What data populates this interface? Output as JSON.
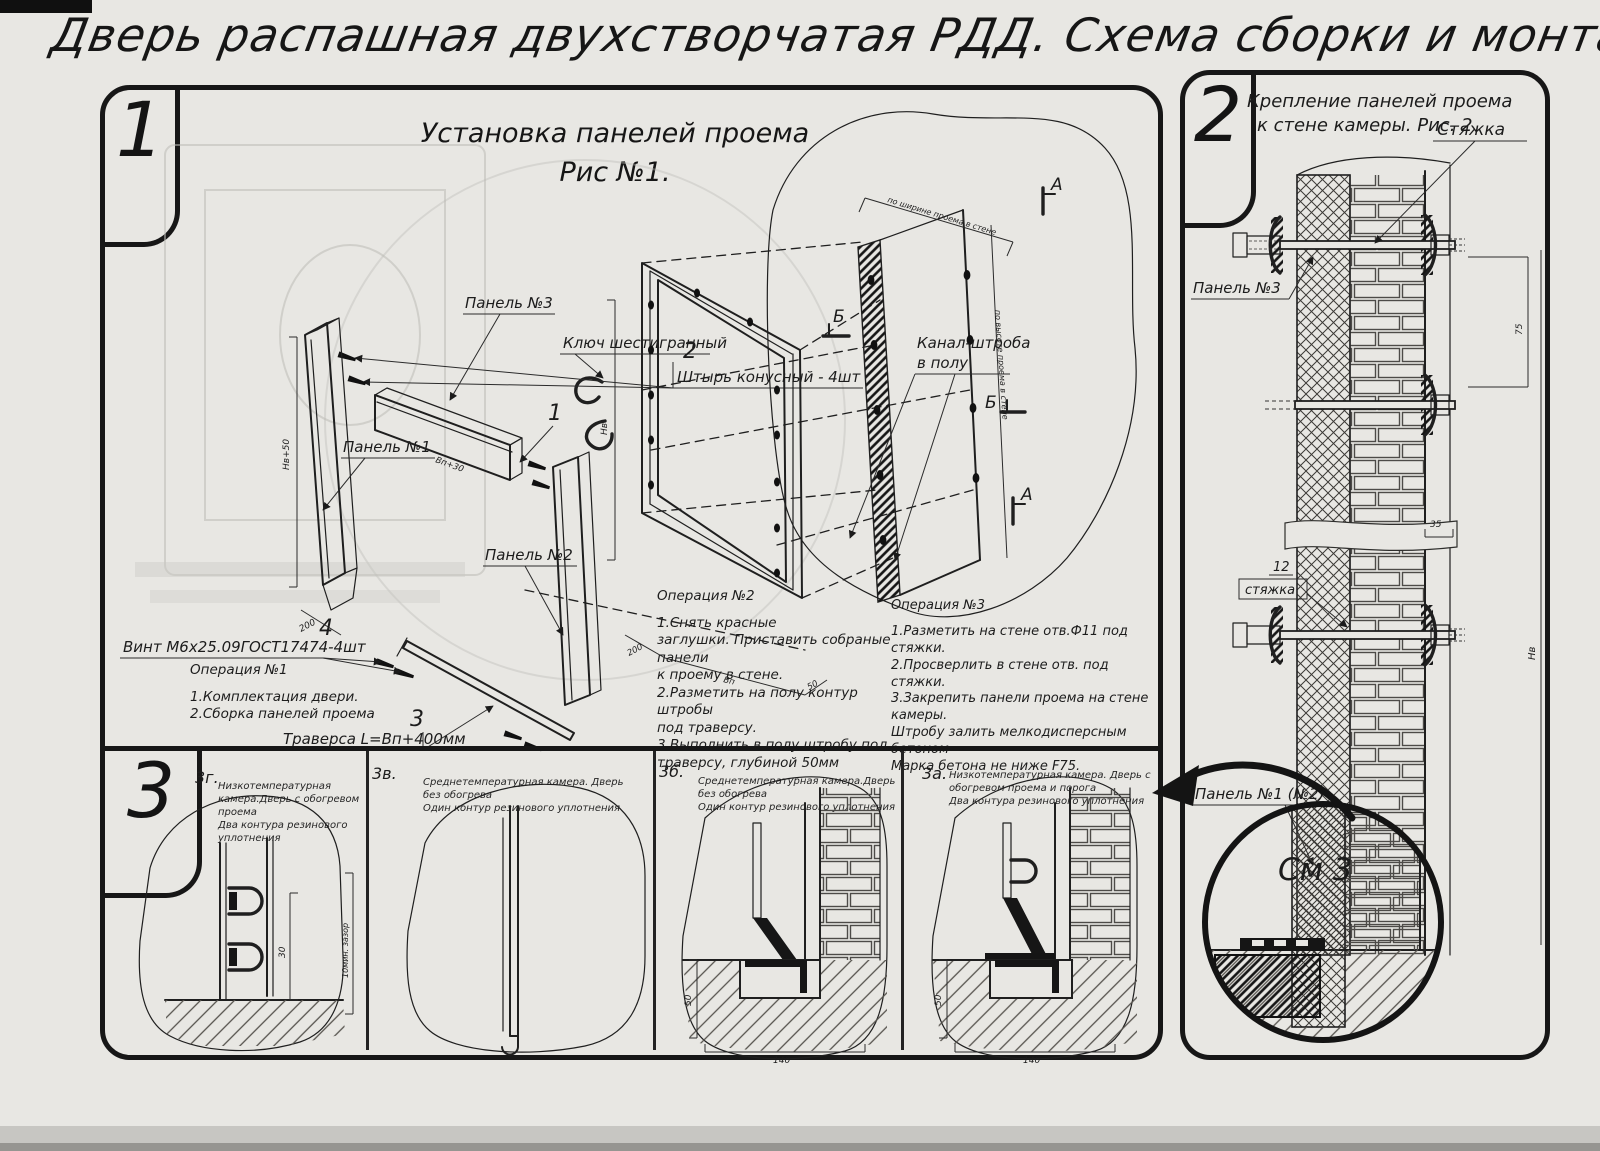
{
  "colors": {
    "ink": "#1b1b1b",
    "paper": "#e8e7e3"
  },
  "title": "Дверь распашная двухстворчатая РДД.  Схема сборки и монтажа №2",
  "s1": {
    "badge": "1",
    "figTitle1": "Установка панелей проема",
    "figTitle2": "Рис №1.",
    "lblHexKey": "Ключ шестигранный",
    "numPin": "2",
    "lblPin": "Штырь конусный - 4шт",
    "lblPanel3": "Панель №3",
    "numPanel3": "1",
    "lblPanel1": "Панель №1",
    "lblPanel2": "Панель №2",
    "numScrew": "4",
    "lblScrew": "Винт М6х25.09ГОСТ17474-4шт",
    "numTraverse": "3",
    "lblTraverse": "Траверса  L=Bп+400мм",
    "lblChannel1": "Канал-штроба",
    "lblChannel2": "в полу",
    "viewA": "А",
    "viewB": "Б",
    "dimH50": "Hв+50",
    "dim200a": "200",
    "dimBp30": "Bп+30",
    "dimHv": "Hв",
    "dim200b": "200",
    "dimBp": "Bп",
    "dim50": "50",
    "dimWallW": "по ширине проема в стене",
    "dimWallH": "по высоте проема в стене",
    "op1t": "Операция №1",
    "op1l1": "1.Комплектация двери.",
    "op1l2": "2.Сборка панелей проема",
    "op2t": "Операция №2",
    "op2l1": "1.Снять красные",
    "op2l2": "заглушки. Приставить собраные панели",
    "op2l3": "к проему в стене.",
    "op2l4": "2.Разметить на полу контур штробы",
    "op2l5": "под траверсу.",
    "op2l6": "3.Выполнить в полу штробу под",
    "op2l7": "траверсу, глубиной 50мм",
    "op3t": "Операция №3",
    "op3l1": "1.Разметить на стене отв.Ф11 под",
    "op3l2": "стяжки.",
    "op3l3": "2.Просверлить в стене отв.  под",
    "op3l4": "стяжки.",
    "op3l5": "3.Закрепить панели проема на стене камеры.",
    "op3l6": "Штробу залить мелкодисперсным бетоном",
    "op3l7": "Марка бетона не ниже   F75."
  },
  "s2": {
    "badge": "2",
    "figTitle1": "Крепление панелей проема",
    "figTitle2": "к стене камеры. Рис. 2",
    "lblTie": "Стяжка",
    "lblPanel3": "Панель №3",
    "num12": "12",
    "lblTie12": "стяжка",
    "lblPanel12": "Панель №1 (№2)",
    "see3": "См 3",
    "dim35": "35",
    "dim75": "75",
    "dimHv": "Hв"
  },
  "s3": {
    "badge": "3",
    "d1code": "3г.",
    "d1cap1": "Низкотемпературная камера.Дверь с обогревом проема",
    "d1cap2": "Два контура резинового уплотнения",
    "d1dimA": "30",
    "d1dimB": "10мин. зазор",
    "d2code": "3в.",
    "d2cap1": "Среднетемпературная камера. Дверь без обогрева",
    "d2cap2": "Один контур резинового уплотнения",
    "d3code": "3б.",
    "d3cap1": "Среднетемпературная камера.Дверь без обогрева",
    "d3cap2": "Один контур резинового уплотнения",
    "d3dimA": "50",
    "d3dimB": "140",
    "d4code": "3а.",
    "d4cap1": "Низкотемпературная камера. Дверь с обогревом проема и порога",
    "d4cap2": "Два контура резинового уплотнения",
    "d4dimA": "50",
    "d4dimB": "140"
  }
}
